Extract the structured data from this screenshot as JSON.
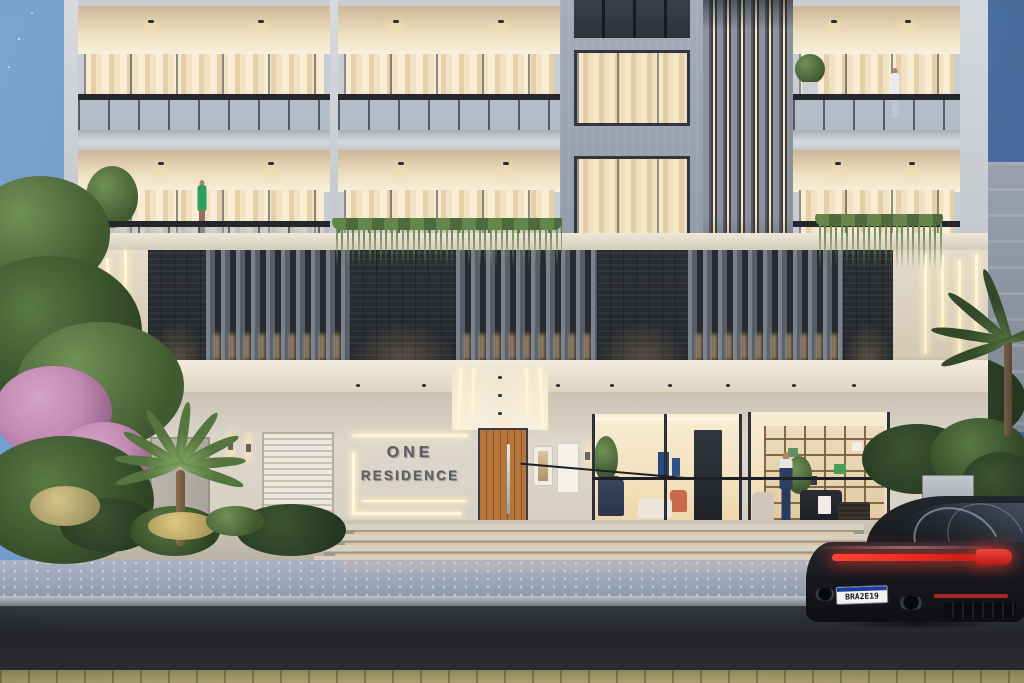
{
  "meta": {
    "domain": "Natural-Image",
    "description": "Dusk architectural rendering of a modern apartment building named ONE RESIDENCE: two floors of warm-lit recessed balconies, a feature band of vertical louvers, stacked stone and LED strips, a glazed ground-floor lobby, landscaped entry with palm, and a dark sports coupe parked on the street at right.",
    "time_of_day": "dusk"
  },
  "building": {
    "name": "ONE RESIDENCE",
    "sign": {
      "line1": "ONE",
      "line2": "RESIDENCE"
    },
    "visible_levels": 3,
    "features": [
      "recessed balconies with glass railings",
      "vertical louver screens with LED gaps",
      "stacked dark stone panels",
      "vertical LED wall strips",
      "lit entrance canopy",
      "timber entrance door",
      "glass-walled lobby with shelving"
    ]
  },
  "people": [
    {
      "location": "left balcony, second floor",
      "outfit_color": "green"
    },
    {
      "location": "right balcony, top floor",
      "outfit_color": "white"
    },
    {
      "location": "ground-floor lobby",
      "outfit_color": "navy"
    }
  ],
  "car": {
    "type": "dark sports coupe (rear view)",
    "license_plate": "BRA2E19",
    "plate_style": "white plate with blue top band",
    "taillight": "full-width red light bar"
  },
  "colors": {
    "sky_top": "#7ba4d1",
    "sky_bottom": "#3f6293",
    "facade_light": "#d2d6db",
    "warm_light": "#f6e8c8",
    "stone_dark": "#26292e",
    "slat_gray": "#767d88",
    "canopy_cream": "#ece3d3",
    "entrance_wall": "#d8d1c6",
    "door_wood": "#b06c33",
    "sign_text": "#5a5e64",
    "street_asphalt": "#26292e",
    "sidewalk": "#9aa5b8",
    "taillight_red": "#e8271d",
    "foliage_green": "#4c6b3a",
    "flower_pink": "#c38ab4",
    "car_body": "#17191e"
  }
}
